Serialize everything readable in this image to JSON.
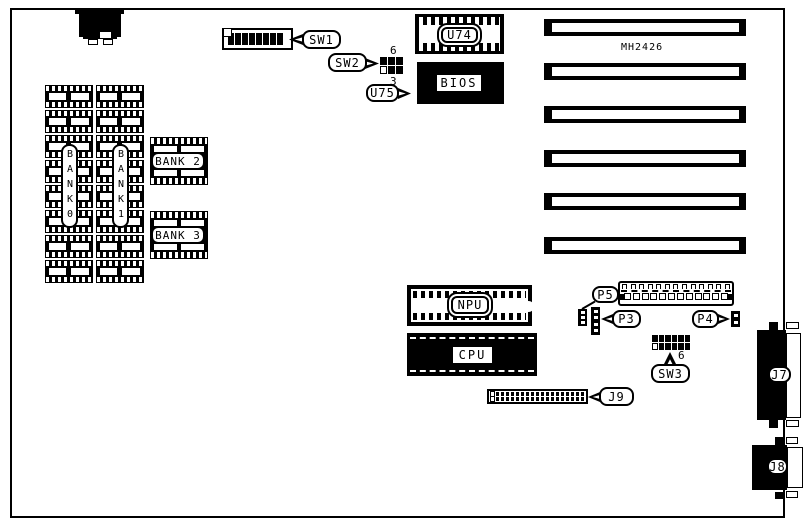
{
  "board": {
    "id_text": "MH2426"
  },
  "callouts": {
    "sw1": "SW1",
    "sw2": "SW2",
    "sw3": "SW3",
    "u74": "U74",
    "u75": "U75",
    "p3": "P3",
    "p4": "P4",
    "p5": "P5",
    "j7": "J7",
    "j8": "J8",
    "j9": "J9"
  },
  "chips": {
    "bios": "BIOS",
    "npu": "NPU",
    "cpu": "CPU"
  },
  "banks": {
    "bank0": "BANK0",
    "bank1": "BANK1",
    "bank2": "BANK 2",
    "bank3": "BANK 3"
  },
  "pin_numbers": {
    "sw2_top": "6",
    "sw2_bottom": "3",
    "sw3_right": "6"
  },
  "counts": {
    "sw1_cells": 8,
    "sw2_cells": 6,
    "sw3_cells": 12,
    "mem_rows": 8,
    "slots": 6,
    "j9_cells": 38,
    "p5_top_pins": 13,
    "p5_bottom_pins": 12,
    "conn_a_cells": 3,
    "conn_b_cells": 4,
    "conn_c_cells": 2
  },
  "colors": {
    "ink": "#000000",
    "paper": "#ffffff"
  }
}
